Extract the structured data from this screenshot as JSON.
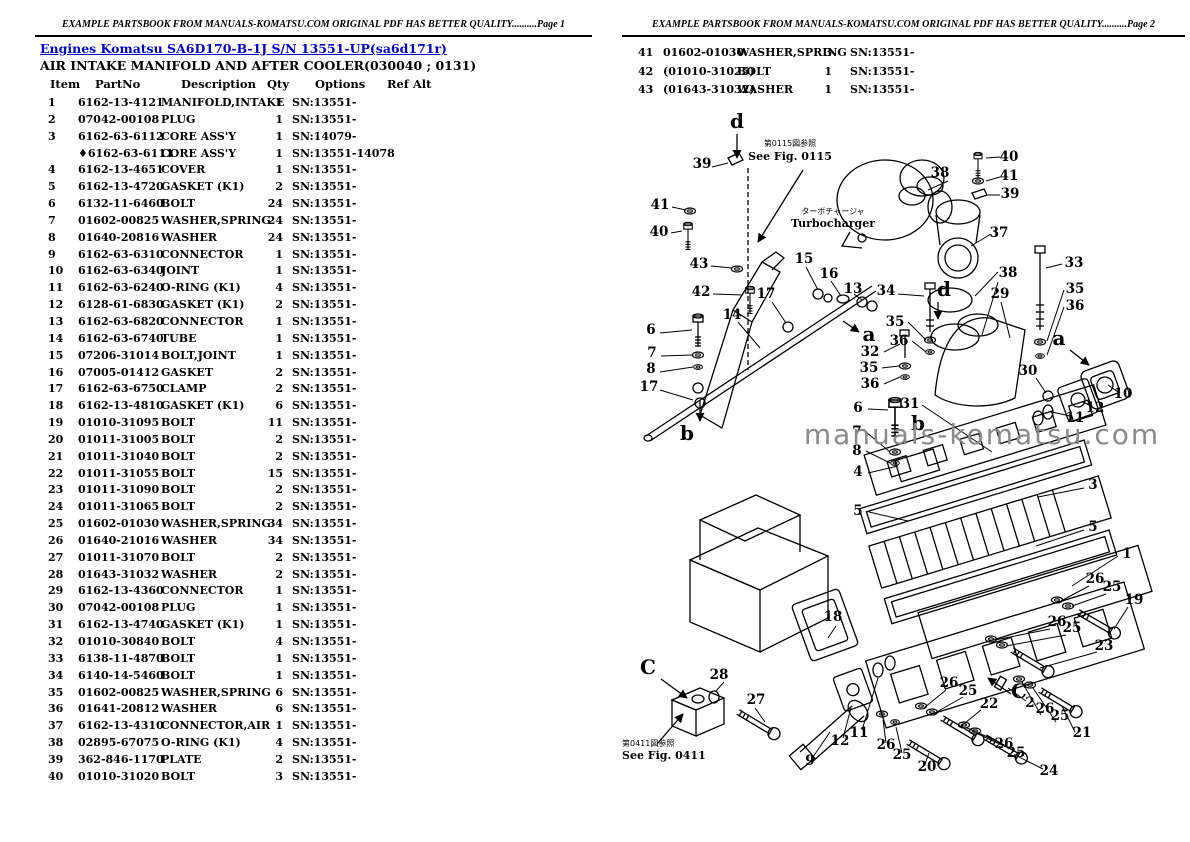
{
  "page1": {
    "header": "EXAMPLE PARTSBOOK FROM MANUALS-KOMATSU.COM ORIGINAL PDF HAS BETTER QUALITY..........Page 1",
    "breadcrumb": "Engines Komatsu SA6D170-B-1J S/N 13551-UP(sa6d171r)",
    "title": "AIR INTAKE MANIFOLD AND AFTER COOLER(030040 ; 0131)",
    "columns": [
      "Item",
      "PartNo",
      "Description",
      "Qty",
      "Options",
      "Ref Alt"
    ],
    "rows": [
      [
        "1",
        "6162-13-4121",
        "MANIFOLD,INTAKE",
        "1",
        "SN:13551-"
      ],
      [
        "2",
        "07042-00108",
        "PLUG",
        "1",
        "SN:13551-"
      ],
      [
        "3",
        "6162-63-6112",
        "CORE ASS'Y",
        "1",
        "SN:14079-"
      ],
      [
        "",
        "♦6162-63-6111",
        "CORE ASS'Y",
        "1",
        "SN:13551-14078"
      ],
      [
        "4",
        "6162-13-4651",
        "COVER",
        "1",
        "SN:13551-"
      ],
      [
        "5",
        "6162-13-4720",
        "GASKET (K1)",
        "2",
        "SN:13551-"
      ],
      [
        "6",
        "6132-11-6460",
        "BOLT",
        "24",
        "SN:13551-"
      ],
      [
        "7",
        "01602-00825",
        "WASHER,SPRING",
        "24",
        "SN:13551-"
      ],
      [
        "8",
        "01640-20816",
        "WASHER",
        "24",
        "SN:13551-"
      ],
      [
        "9",
        "6162-63-6310",
        "CONNECTOR",
        "1",
        "SN:13551-"
      ],
      [
        "10",
        "6162-63-6340",
        "JOINT",
        "1",
        "SN:13551-"
      ],
      [
        "11",
        "6162-63-6240",
        "O-RING (K1)",
        "4",
        "SN:13551-"
      ],
      [
        "12",
        "6128-61-6830",
        "GASKET (K1)",
        "2",
        "SN:13551-"
      ],
      [
        "13",
        "6162-63-6820",
        "CONNECTOR",
        "1",
        "SN:13551-"
      ],
      [
        "14",
        "6162-63-6740",
        "TUBE",
        "1",
        "SN:13551-"
      ],
      [
        "15",
        "07206-31014",
        "BOLT,JOINT",
        "1",
        "SN:13551-"
      ],
      [
        "16",
        "07005-01412",
        "GASKET",
        "2",
        "SN:13551-"
      ],
      [
        "17",
        "6162-63-6750",
        "CLAMP",
        "2",
        "SN:13551-"
      ],
      [
        "18",
        "6162-13-4810",
        "GASKET (K1)",
        "6",
        "SN:13551-"
      ],
      [
        "19",
        "01010-31095",
        "BOLT",
        "11",
        "SN:13551-"
      ],
      [
        "20",
        "01011-31005",
        "BOLT",
        "2",
        "SN:13551-"
      ],
      [
        "21",
        "01011-31040",
        "BOLT",
        "2",
        "SN:13551-"
      ],
      [
        "22",
        "01011-31055",
        "BOLT",
        "15",
        "SN:13551-"
      ],
      [
        "23",
        "01011-31090",
        "BOLT",
        "2",
        "SN:13551-"
      ],
      [
        "24",
        "01011-31065",
        "BOLT",
        "2",
        "SN:13551-"
      ],
      [
        "25",
        "01602-01030",
        "WASHER,SPRING",
        "34",
        "SN:13551-"
      ],
      [
        "26",
        "01640-21016",
        "WASHER",
        "34",
        "SN:13551-"
      ],
      [
        "27",
        "01011-31070",
        "BOLT",
        "2",
        "SN:13551-"
      ],
      [
        "28",
        "01643-31032",
        "WASHER",
        "2",
        "SN:13551-"
      ],
      [
        "29",
        "6162-13-4360",
        "CONNECTOR",
        "1",
        "SN:13551-"
      ],
      [
        "30",
        "07042-00108",
        "PLUG",
        "1",
        "SN:13551-"
      ],
      [
        "31",
        "6162-13-4740",
        "GASKET (K1)",
        "1",
        "SN:13551-"
      ],
      [
        "32",
        "01010-30840",
        "BOLT",
        "4",
        "SN:13551-"
      ],
      [
        "33",
        "6138-11-4870",
        "BOLT",
        "1",
        "SN:13551-"
      ],
      [
        "34",
        "6140-14-5460",
        "BOLT",
        "1",
        "SN:13551-"
      ],
      [
        "35",
        "01602-00825",
        "WASHER,SPRING",
        "6",
        "SN:13551-"
      ],
      [
        "36",
        "01641-20812",
        "WASHER",
        "6",
        "SN:13551-"
      ],
      [
        "37",
        "6162-13-4310",
        "CONNECTOR,AIR",
        "1",
        "SN:13551-"
      ],
      [
        "38",
        "02895-67075",
        "O-RING (K1)",
        "4",
        "SN:13551-"
      ],
      [
        "39",
        "362-846-1170",
        "PLATE",
        "2",
        "SN:13551-"
      ],
      [
        "40",
        "01010-31020",
        "BOLT",
        "3",
        "SN:13551-"
      ]
    ]
  },
  "page2": {
    "header": "EXAMPLE PARTSBOOK FROM MANUALS-KOMATSU.COM ORIGINAL PDF HAS BETTER QUALITY..........Page 2",
    "rows": [
      [
        "41",
        "01602-01030",
        "WASHER,SPRING",
        "3",
        "SN:13551-"
      ],
      [
        "42",
        "(01010-31025)",
        "BOLT",
        "1",
        "SN:13551-"
      ],
      [
        "43",
        "(01643-31032)",
        "WASHER",
        "1",
        "SN:13551-"
      ]
    ]
  },
  "diagram": {
    "watermark": "manuals-komatsu.com",
    "notes": {
      "fig0115_jp": "第0115図参照",
      "fig0115_en": "See Fig. 0115",
      "fig0411_jp": "第0411図参照",
      "fig0411_en": "See Fig. 0411",
      "turbo_jp": "ターボチャージャ",
      "turbo_en": "Turbocharger"
    },
    "labels": [
      {
        "t": "d",
        "x": 737,
        "y": 128,
        "k": "l"
      },
      {
        "t": "39",
        "x": 702,
        "y": 168
      },
      {
        "t": "41",
        "x": 660,
        "y": 209
      },
      {
        "t": "40",
        "x": 659,
        "y": 236
      },
      {
        "t": "43",
        "x": 699,
        "y": 268
      },
      {
        "t": "42",
        "x": 701,
        "y": 296
      },
      {
        "t": "14",
        "x": 732,
        "y": 319
      },
      {
        "t": "17",
        "x": 766,
        "y": 298
      },
      {
        "t": "15",
        "x": 804,
        "y": 263
      },
      {
        "t": "16",
        "x": 829,
        "y": 278
      },
      {
        "t": "13",
        "x": 853,
        "y": 293
      },
      {
        "t": "34",
        "x": 886,
        "y": 295
      },
      {
        "t": "6",
        "x": 651,
        "y": 334
      },
      {
        "t": "7",
        "x": 652,
        "y": 357
      },
      {
        "t": "8",
        "x": 651,
        "y": 373
      },
      {
        "t": "17",
        "x": 649,
        "y": 391
      },
      {
        "t": "b",
        "x": 687,
        "y": 440,
        "k": "l"
      },
      {
        "t": "a",
        "x": 869,
        "y": 341,
        "k": "l"
      },
      {
        "t": "35",
        "x": 895,
        "y": 326
      },
      {
        "t": "36",
        "x": 899,
        "y": 345
      },
      {
        "t": "32",
        "x": 870,
        "y": 356
      },
      {
        "t": "35",
        "x": 869,
        "y": 372
      },
      {
        "t": "36",
        "x": 870,
        "y": 388
      },
      {
        "t": "6",
        "x": 858,
        "y": 412
      },
      {
        "t": "7",
        "x": 857,
        "y": 436
      },
      {
        "t": "8",
        "x": 857,
        "y": 455
      },
      {
        "t": "4",
        "x": 858,
        "y": 476
      },
      {
        "t": "5",
        "x": 858,
        "y": 515
      },
      {
        "t": "31",
        "x": 910,
        "y": 408
      },
      {
        "t": "b",
        "x": 918,
        "y": 430,
        "k": "l"
      },
      {
        "t": "38",
        "x": 940,
        "y": 177
      },
      {
        "t": "40",
        "x": 1009,
        "y": 161
      },
      {
        "t": "41",
        "x": 1009,
        "y": 180
      },
      {
        "t": "39",
        "x": 1010,
        "y": 198
      },
      {
        "t": "37",
        "x": 999,
        "y": 237
      },
      {
        "t": "38",
        "x": 1008,
        "y": 277
      },
      {
        "t": "29",
        "x": 1000,
        "y": 298
      },
      {
        "t": "d",
        "x": 944,
        "y": 296,
        "k": "l"
      },
      {
        "t": "33",
        "x": 1074,
        "y": 267
      },
      {
        "t": "35",
        "x": 1075,
        "y": 293
      },
      {
        "t": "36",
        "x": 1075,
        "y": 310
      },
      {
        "t": "30",
        "x": 1028,
        "y": 375
      },
      {
        "t": "a",
        "x": 1059,
        "y": 345,
        "k": "l"
      },
      {
        "t": "10",
        "x": 1123,
        "y": 398
      },
      {
        "t": "12",
        "x": 1095,
        "y": 412
      },
      {
        "t": "11",
        "x": 1075,
        "y": 422
      },
      {
        "t": "3",
        "x": 1093,
        "y": 489
      },
      {
        "t": "5",
        "x": 1093,
        "y": 531
      },
      {
        "t": "1",
        "x": 1127,
        "y": 558
      },
      {
        "t": "18",
        "x": 833,
        "y": 621
      },
      {
        "t": "26",
        "x": 1095,
        "y": 583
      },
      {
        "t": "25",
        "x": 1112,
        "y": 591
      },
      {
        "t": "19",
        "x": 1134,
        "y": 604
      },
      {
        "t": "26",
        "x": 1057,
        "y": 626
      },
      {
        "t": "25",
        "x": 1072,
        "y": 632
      },
      {
        "t": "23",
        "x": 1104,
        "y": 650
      },
      {
        "t": "26",
        "x": 949,
        "y": 687
      },
      {
        "t": "25",
        "x": 968,
        "y": 695
      },
      {
        "t": "22",
        "x": 989,
        "y": 708
      },
      {
        "t": "C",
        "x": 1019,
        "y": 698,
        "k": "l"
      },
      {
        "t": "2",
        "x": 1030,
        "y": 707
      },
      {
        "t": "26",
        "x": 1045,
        "y": 713
      },
      {
        "t": "25",
        "x": 1060,
        "y": 720
      },
      {
        "t": "21",
        "x": 1082,
        "y": 737
      },
      {
        "t": "26",
        "x": 1004,
        "y": 748
      },
      {
        "t": "25",
        "x": 1016,
        "y": 757
      },
      {
        "t": "24",
        "x": 1049,
        "y": 775
      },
      {
        "t": "20",
        "x": 927,
        "y": 771
      },
      {
        "t": "C",
        "x": 648,
        "y": 674,
        "k": "l"
      },
      {
        "t": "28",
        "x": 719,
        "y": 679
      },
      {
        "t": "27",
        "x": 756,
        "y": 704
      },
      {
        "t": "9",
        "x": 810,
        "y": 765
      },
      {
        "t": "12",
        "x": 840,
        "y": 745
      },
      {
        "t": "11",
        "x": 859,
        "y": 737
      },
      {
        "t": "26",
        "x": 886,
        "y": 749
      },
      {
        "t": "25",
        "x": 902,
        "y": 759
      }
    ]
  },
  "colors": {
    "link": "#0000cc",
    "watermark": "#8a8a8a",
    "ink": "#000000"
  }
}
